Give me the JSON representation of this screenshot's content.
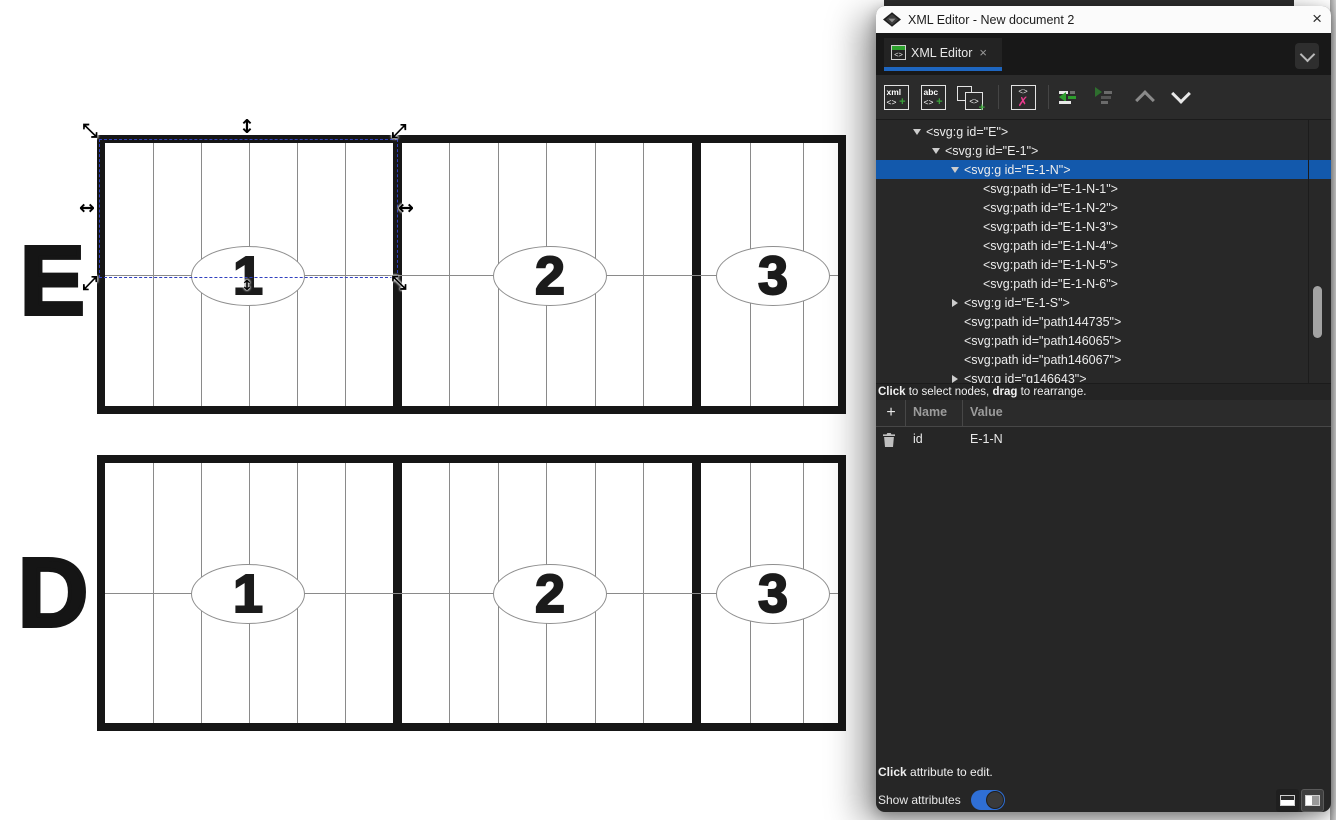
{
  "window": {
    "title": "XML Editor - New document 2",
    "close_glyph": "×"
  },
  "tab": {
    "label": "XML Editor",
    "close_glyph": "×",
    "icon_glyph": "<>"
  },
  "toolbar": {
    "new_element_glyph_top": "xml",
    "new_element_glyph_code": "<>",
    "new_element_plus": "+",
    "new_text_glyph_top": "abc",
    "new_text_glyph_code": "<>",
    "new_text_plus": "+",
    "duplicate_glyph_code": "<>",
    "duplicate_plus": "+",
    "delete_glyph_code": "<>",
    "delete_x": "✗"
  },
  "tree": {
    "rows": [
      {
        "text": "<svg:g id=\"E\">"
      },
      {
        "text": "<svg:g id=\"E-1\">"
      },
      {
        "text": "<svg:g id=\"E-1-N\">"
      },
      {
        "text": "<svg:path id=\"E-1-N-1\">"
      },
      {
        "text": "<svg:path id=\"E-1-N-2\">"
      },
      {
        "text": "<svg:path id=\"E-1-N-3\">"
      },
      {
        "text": "<svg:path id=\"E-1-N-4\">"
      },
      {
        "text": "<svg:path id=\"E-1-N-5\">"
      },
      {
        "text": "<svg:path id=\"E-1-N-6\">"
      },
      {
        "text": "<svg:g id=\"E-1-S\">"
      },
      {
        "text": "<svg:path id=\"path144735\">"
      },
      {
        "text": "<svg:path id=\"path146065\">"
      },
      {
        "text": "<svg:path id=\"path146067\">"
      },
      {
        "text": "<svg:g id=\"g146643\">"
      }
    ],
    "hint": {
      "bold1": "Click",
      "text1": " to select nodes, ",
      "bold2": "drag",
      "text2": " to rearrange."
    }
  },
  "attributes": {
    "add_glyph": "+",
    "headers": {
      "name": "Name",
      "value": "Value"
    },
    "rows": [
      {
        "name": "id",
        "value": "E-1-N"
      }
    ],
    "hint": {
      "bold1": "Click",
      "text1": " attribute to edit."
    },
    "show_attributes_label": "Show attributes",
    "show_attributes_on": true
  },
  "canvas": {
    "rows": [
      {
        "letter": "E",
        "sections": [
          {
            "number": "1"
          },
          {
            "number": "2"
          },
          {
            "number": "3"
          }
        ]
      },
      {
        "letter": "D",
        "sections": [
          {
            "number": "1"
          },
          {
            "number": "2"
          },
          {
            "number": "3"
          }
        ]
      }
    ],
    "selection_handles": {
      "horizontal": "↔",
      "vertical": "↕",
      "diag_nwse": "⤡",
      "diag_nesw": "⤢"
    }
  },
  "colors": {
    "selected_row": "#1359ac",
    "tab_underline": "#1e66c0",
    "toggle_on": "#2f6fd6",
    "icon_green": "#3aa33a",
    "icon_pink": "#ea3b8d"
  }
}
